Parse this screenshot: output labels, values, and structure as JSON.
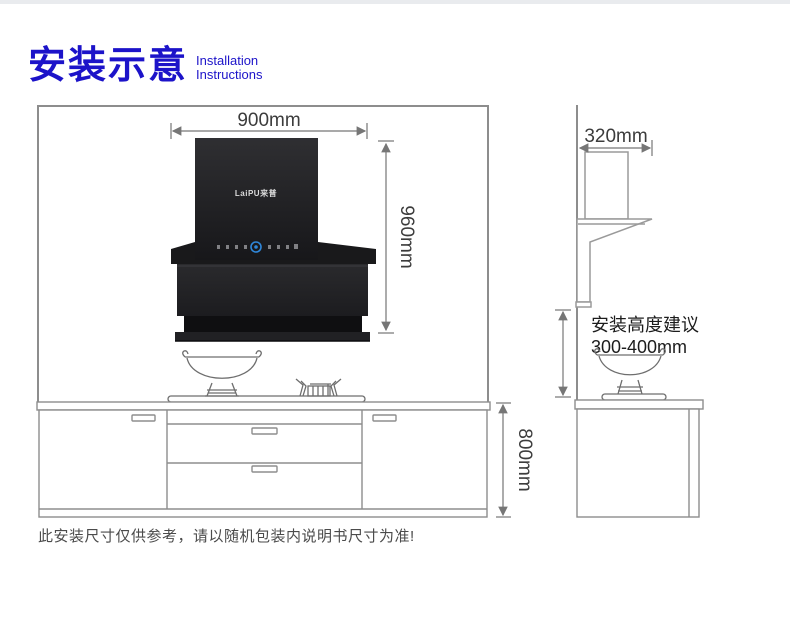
{
  "header": {
    "title_cn": "安装示意",
    "subtitle_line1": "Installation",
    "subtitle_line2": "Instructions"
  },
  "front_view": {
    "hood_width": "900mm",
    "hood_height": "960mm",
    "cabinet_height": "800mm",
    "brand_logo": "LaiPU来普"
  },
  "side_view": {
    "hood_depth": "320mm",
    "install_height_note_line1": "安装高度建议",
    "install_height_note_line2": "300-400mm"
  },
  "footer": {
    "disclaimer": "此安装尺寸仅供参考，请以随机包装内说明书尺寸为准!"
  },
  "colors": {
    "title_blue": "#1c13c9",
    "dimension_gray": "#767676",
    "outline_gray": "#8d8d8d",
    "hood_black": "#1b1b1d",
    "control_ring_blue": "#2f87da",
    "topbar_gray": "#e9ebee"
  }
}
